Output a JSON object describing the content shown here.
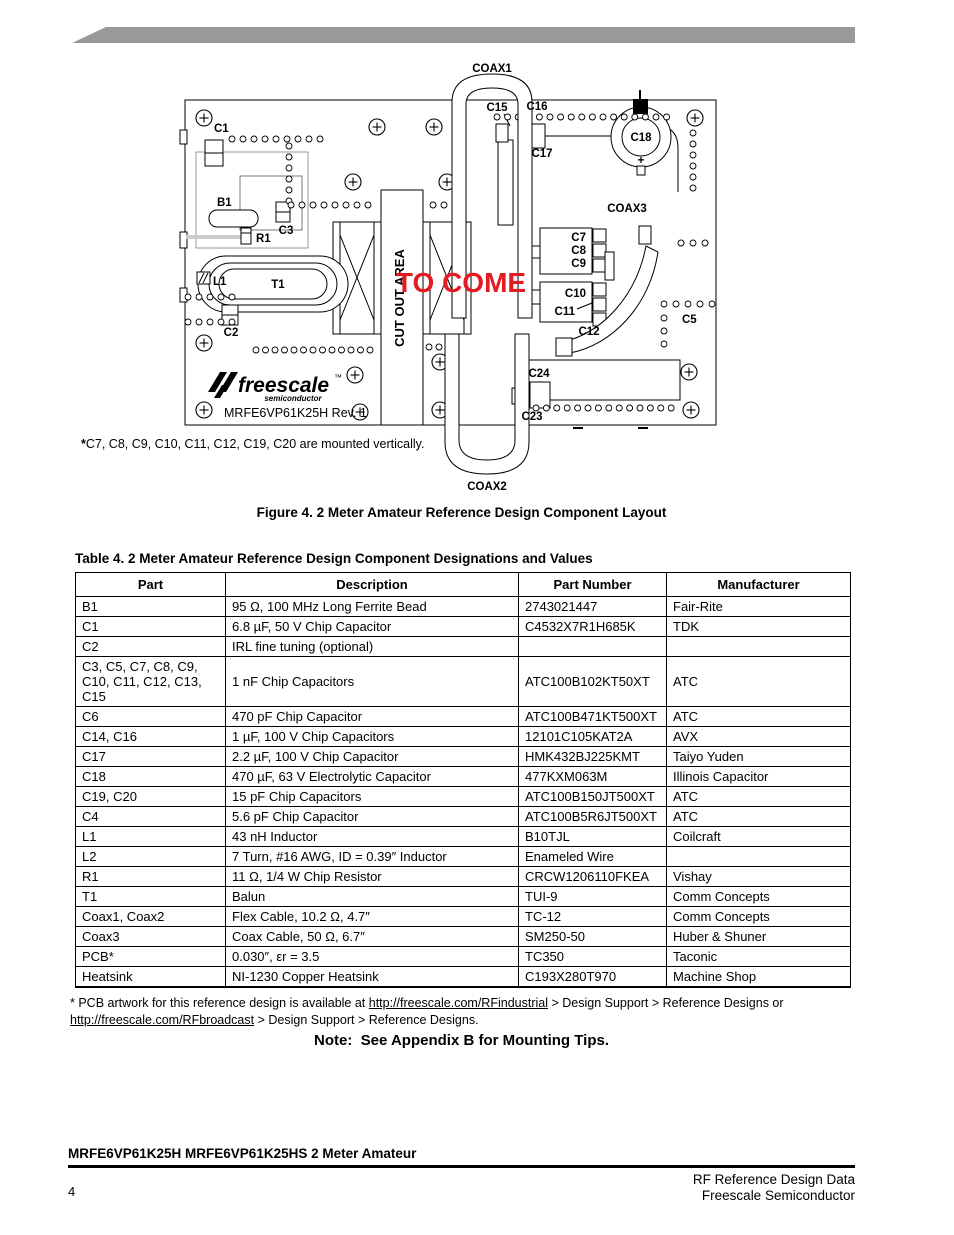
{
  "banner": {
    "color": "#999999"
  },
  "figure": {
    "labels": {
      "coax1": "COAX1",
      "coax2": "COAX2",
      "coax3": "COAX3",
      "c1": "C1",
      "b1": "B1",
      "c3": "C3",
      "r1": "R1",
      "t1": "T1",
      "l1": "L1",
      "c2": "C2",
      "c5": "C5",
      "c7": "C7",
      "c8": "C8",
      "c9": "C9",
      "c10": "C10",
      "c11": "C11",
      "c12": "C12",
      "c15": "C15",
      "c16": "C16",
      "c17": "C17",
      "c18": "C18",
      "c18_plus": "+",
      "c23": "C23",
      "c24": "C24",
      "to_come": "TO COME",
      "cut_out_area": "CUT OUT AREA",
      "logo": "freescale",
      "logo_tm": "™",
      "logo_sub": "semiconductor",
      "rev": "MRFE6VP61K25H Rev. 1"
    },
    "accent_red": "#E31B23",
    "footnote_star": "*",
    "footnote": "C7, C8, C9, C10, C11, C12, C19, C20 are mounted vertically.",
    "caption": "Figure 4. 2 Meter Amateur Reference Design Component Layout"
  },
  "table": {
    "title": "Table 4. 2 Meter Amateur Reference Design Component Designations and Values",
    "headers": [
      "Part",
      "Description",
      "Part Number",
      "Manufacturer"
    ],
    "rows": [
      {
        "part": "B1",
        "description": "95 Ω, 100 MHz Long Ferrite Bead",
        "part_number": "2743021447",
        "manufacturer": "Fair-Rite"
      },
      {
        "part": "C1",
        "description": "6.8 µF, 50 V Chip Capacitor",
        "part_number": "C4532X7R1H685K",
        "manufacturer": "TDK"
      },
      {
        "part": "C2",
        "description": "IRL fine tuning (optional)",
        "part_number": "",
        "manufacturer": ""
      },
      {
        "part": "C3, C5, C7, C8, C9,\nC10, C11, C12, C13,\nC15",
        "description": "1 nF Chip Capacitors",
        "part_number": "ATC100B102KT50XT",
        "manufacturer": "ATC"
      },
      {
        "part": "C6",
        "description": "470 pF Chip Capacitor",
        "part_number": "ATC100B471KT500XT",
        "manufacturer": "ATC"
      },
      {
        "part": "C14, C16",
        "description": "1 µF, 100 V Chip Capacitors",
        "part_number": "12101C105KAT2A",
        "manufacturer": "AVX"
      },
      {
        "part": "C17",
        "description": "2.2 µF, 100 V Chip Capacitor",
        "part_number": "HMK432BJ225KMT",
        "manufacturer": "Taiyo Yuden"
      },
      {
        "part": "C18",
        "description": "470 µF, 63 V Electrolytic Capacitor",
        "part_number": "477KXM063M",
        "manufacturer": "Illinois Capacitor"
      },
      {
        "part": "C19, C20",
        "description": "15 pF Chip Capacitors",
        "part_number": "ATC100B150JT500XT",
        "manufacturer": "ATC"
      },
      {
        "part": "C4",
        "description": "5.6 pF Chip Capacitor",
        "part_number": "ATC100B5R6JT500XT",
        "manufacturer": "ATC"
      },
      {
        "part": "L1",
        "description": "43 nH Inductor",
        "part_number": "B10TJL",
        "manufacturer": "Coilcraft"
      },
      {
        "part": "L2",
        "description": "7 Turn, #16 AWG, ID = 0.39″ Inductor",
        "part_number": "Enameled Wire",
        "manufacturer": ""
      },
      {
        "part": "R1",
        "description": "11 Ω, 1/4 W Chip Resistor",
        "part_number": "CRCW1206110FKEA",
        "manufacturer": "Vishay"
      },
      {
        "part": "T1",
        "description": "Balun",
        "part_number": "TUI-9",
        "manufacturer": "Comm Concepts"
      },
      {
        "part": "Coax1, Coax2",
        "description": "Flex Cable, 10.2 Ω, 4.7″",
        "part_number": "TC-12",
        "manufacturer": "Comm Concepts"
      },
      {
        "part": "Coax3",
        "description": "Coax Cable, 50 Ω, 6.7″",
        "part_number": "SM250-50",
        "manufacturer": "Huber & Shuner"
      },
      {
        "part": "PCB*",
        "description": "0.030″, εr = 3.5",
        "part_number": "TC350",
        "manufacturer": "Taconic"
      },
      {
        "part": "Heatsink",
        "description": "NI-1230 Copper Heatsink",
        "part_number": "C193X280T970",
        "manufacturer": "Machine Shop"
      }
    ]
  },
  "footnote": {
    "part1": "* PCB artwork for this reference design is available at ",
    "link1": "http://freescale.com/RFindustrial",
    "part2": " > Design Support > Reference Designs or",
    "link2": "http://freescale.com/RFbroadcast",
    "part3": " > Design Support > Reference Designs."
  },
  "note": "Note:  See Appendix B for Mounting Tips.",
  "footer": {
    "product_line": "MRFE6VP61K25H MRFE6VP61K25HS 2 Meter Amateur",
    "page_number": "4",
    "right_line1": "RF Reference Design Data",
    "right_line2": "Freescale Semiconductor"
  }
}
